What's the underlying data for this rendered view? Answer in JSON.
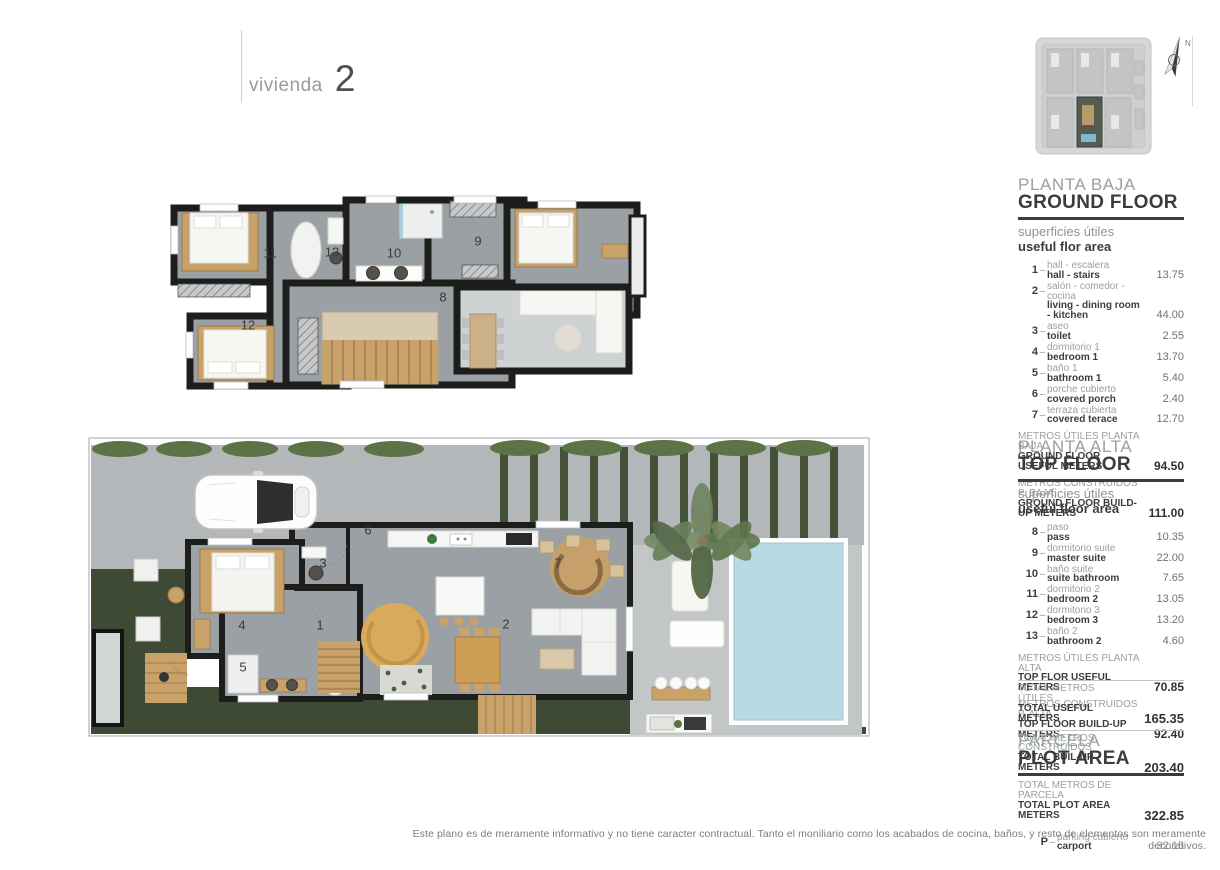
{
  "ui": {
    "dash": "–",
    "compass_n": "N"
  },
  "page": {
    "title_label": "vivienda",
    "title_number": "2",
    "disclaimer": "Este plano es de meramente informativo y no tiene caracter contractual. Tanto el moniliario como los acabados de cocina, baños, y resto de elementos son meramente decorativos."
  },
  "sections": {
    "ground": {
      "title_es": "PLANTA BAJA",
      "title_en": "GROUND FLOOR",
      "subtitle_es": "superficies útiles",
      "subtitle_en": "useful flor area",
      "rows": [
        {
          "num": "1",
          "es": "hall - escalera",
          "en": "hall - stairs",
          "value": "13.75"
        },
        {
          "num": "2",
          "es": "salón - comedor - cocina",
          "en": "living - dining room - kitchen",
          "value": "44.00"
        },
        {
          "num": "3",
          "es": "aseo",
          "en": "toilet",
          "value": "2.55"
        },
        {
          "num": "4",
          "es": "dormitorio 1",
          "en": "bedroom 1",
          "value": "13.70"
        },
        {
          "num": "5",
          "es": "baño 1",
          "en": "bathroom 1",
          "value": "5.40"
        },
        {
          "num": "6",
          "es": "porche cubierto",
          "en": "covered porch",
          "value": "2.40"
        },
        {
          "num": "7",
          "es": "terraza cubierta",
          "en": "covered terace",
          "value": "12.70"
        }
      ],
      "subtotals": [
        {
          "es": "METROS ÚTILES PLANTA BAJA",
          "en": "GROUND FLOOR USEFUL METERS",
          "value": "94.50"
        },
        {
          "es": "METROS CONSTRUIDOS P. BAJA",
          "en": "GROUND FLOOR BUILD-UP METERS",
          "value": "111.00"
        }
      ]
    },
    "alta": {
      "title_es": "PLANTA ALTA",
      "title_en": "TOP FLOOR",
      "subtitle_es": "superficies útiles",
      "subtitle_en": "useful floor area",
      "rows": [
        {
          "num": "8",
          "es": "paso",
          "en": "pass",
          "value": "10.35"
        },
        {
          "num": "9",
          "es": "dormitorio suite",
          "en": "master suite",
          "value": "22.00"
        },
        {
          "num": "10",
          "es": "baño suite",
          "en": "suite bathroom",
          "value": "7.65"
        },
        {
          "num": "11",
          "es": "dormitorio 2",
          "en": "bedroom 2",
          "value": "13.05"
        },
        {
          "num": "12",
          "es": "dormitorio 3",
          "en": "bedroom 3",
          "value": "13.20"
        },
        {
          "num": "13",
          "es": "baño 2",
          "en": "bathroom 2",
          "value": "4.60"
        }
      ],
      "subtotals": [
        {
          "es": "METROS ÚTILES PLANTA ALTA",
          "en": "TOP FLOR USEFUL METERS",
          "value": "70.85"
        },
        {
          "es": "METROS CONSTRUIDOS P. ALTA",
          "en": "TOP FLOOR BUILD-UP METERS",
          "value": "92.40"
        }
      ]
    },
    "totals": [
      {
        "es": "TOTAL METROS ÚTILES",
        "en": "TOTAL USEFUL METERS",
        "value": "165.35"
      },
      {
        "es": "TOTAL METROS CONSTRUIDOS",
        "en": "TOTAL BUIL-UP METERS",
        "value": "203.40"
      }
    ],
    "parcela": {
      "title_es": "PARCELA",
      "title_en": "PLOT AREA",
      "totals": [
        {
          "es": "TOTAL METROS DE PARCELA",
          "en": "TOTAL PLOT AREA METERS",
          "value": "322.85"
        }
      ],
      "items": [
        {
          "num": "P",
          "es": "parking cubierto",
          "en": "carport",
          "value": "32.15"
        }
      ]
    }
  },
  "plans": {
    "top_floor": {
      "labels": {
        "r8": "8",
        "r9": "9",
        "r10": "10",
        "r11": "11",
        "r12": "12",
        "r13": "13"
      }
    },
    "ground_floor": {
      "labels": {
        "r1": "1",
        "r2": "2",
        "r3": "3",
        "r4": "4",
        "r5": "5",
        "r6": "6",
        "r7": "7"
      }
    }
  },
  "colors": {
    "wall": "#1d1d1b",
    "floor": "#9aa0a4",
    "void_floor": "#cfd2d3",
    "concrete": "#b4b7b9",
    "pool_deck": "#c3c6c7",
    "pool": "#b7dbe4",
    "grass": "#3e4a33",
    "hedge": "#5c7247",
    "pergola": "#44523a",
    "wood": "#c9a26a",
    "rug": "#d9a95c",
    "white_furniture": "#f6f6f3"
  }
}
